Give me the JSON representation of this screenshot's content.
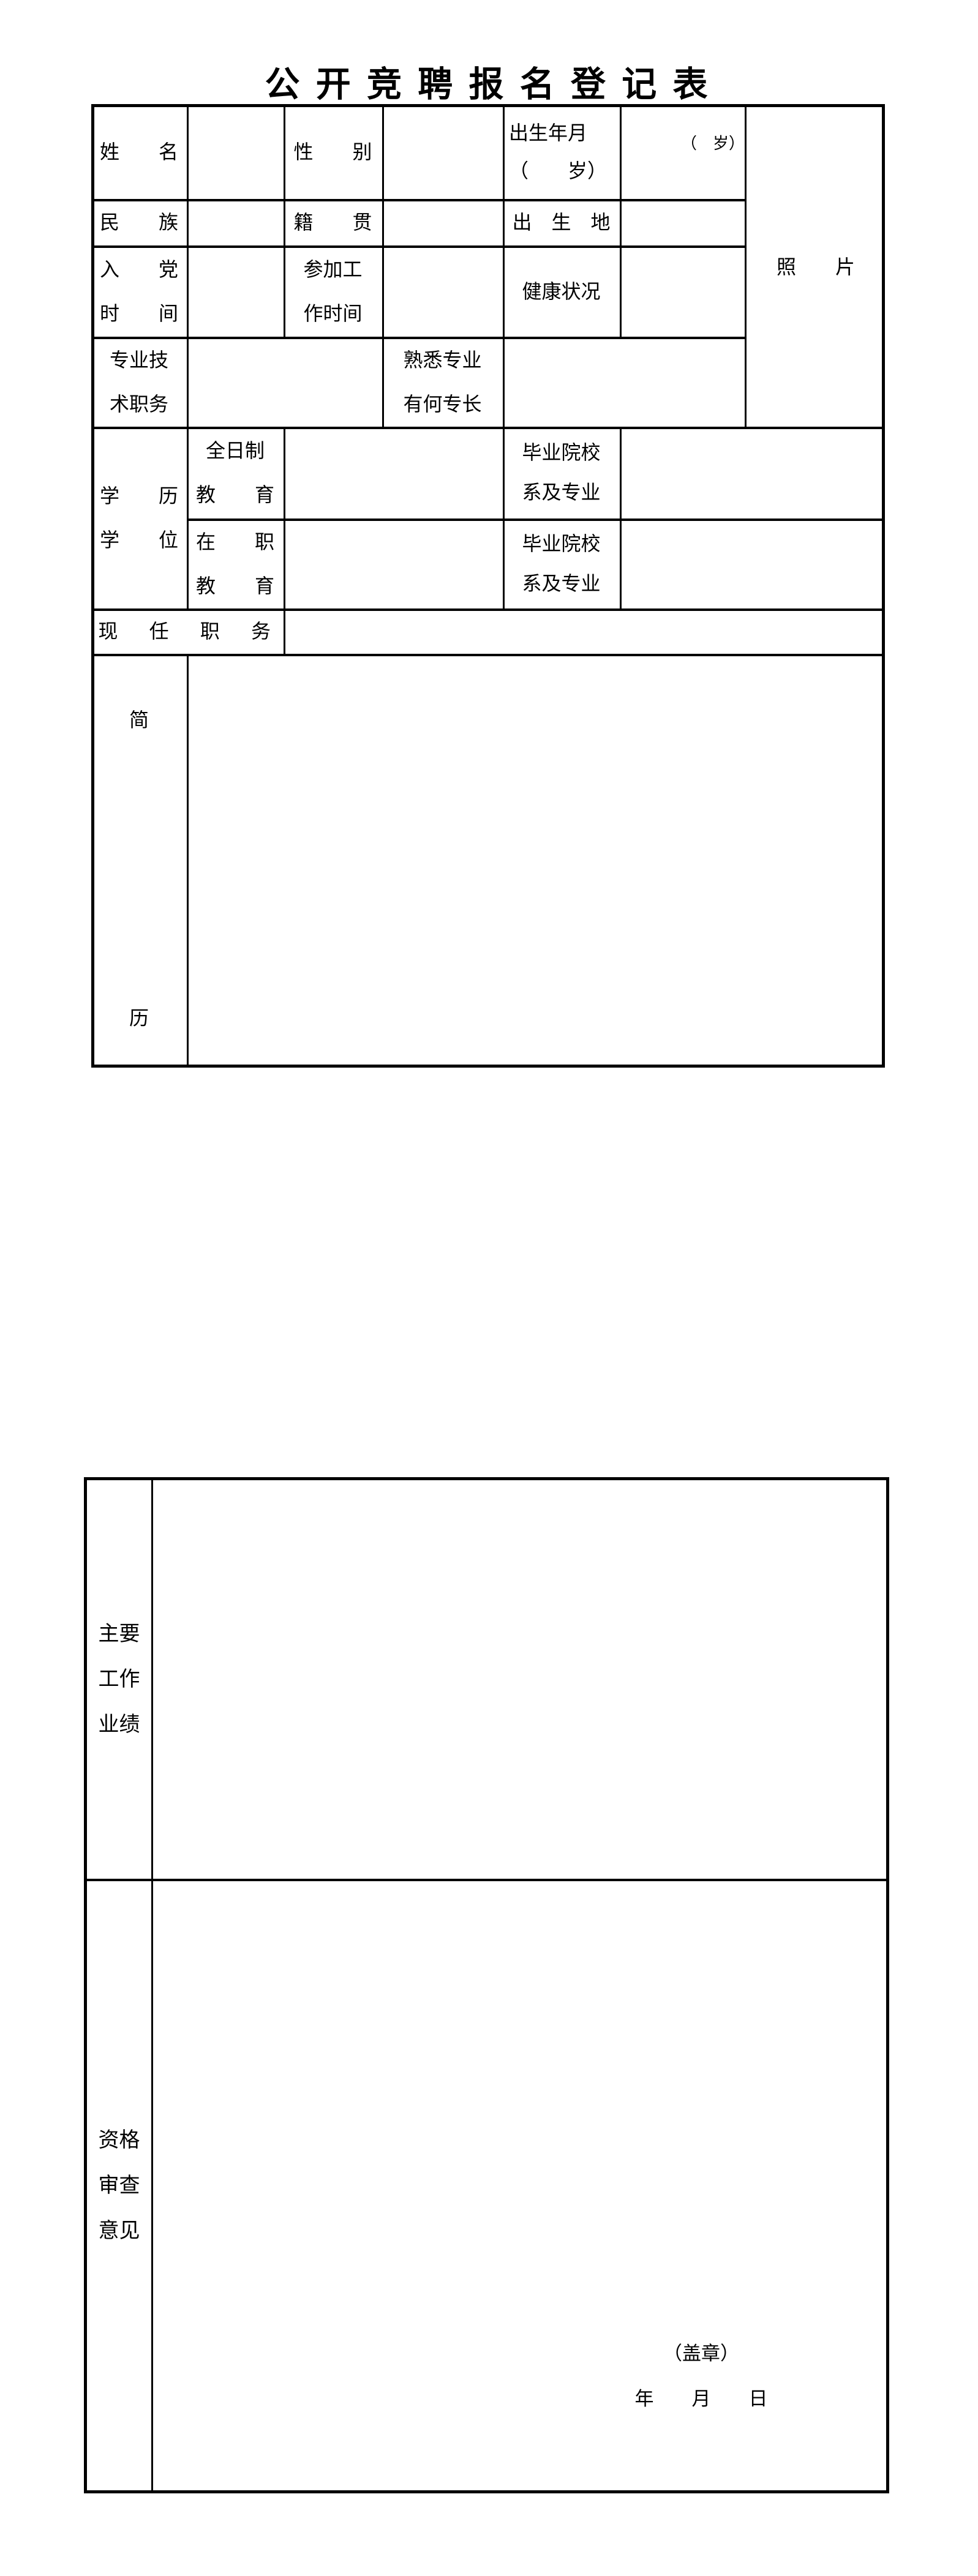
{
  "title": "公 开 竞 聘 报 名 登 记 表",
  "form": {
    "name_label": "姓　　名",
    "gender_label": "性　　别",
    "birth_date_label_l1": "出生年月",
    "birth_date_label_l2": "（　　岁）",
    "age_hint": "（　岁）",
    "ethnicity_label": "民　　族",
    "native_place_label": "籍　　贯",
    "birthplace_label": "出　生　地",
    "party_time_label_l1": "入　　党",
    "party_time_label_l2": "时　　间",
    "work_time_label_l1": "参加工",
    "work_time_label_l2": "作时间",
    "health_label": "健康状况",
    "photo_label": "照　　片",
    "prof_title_label_l1": "专业技",
    "prof_title_label_l2": "术职务",
    "specialty_label_l1": "熟悉专业",
    "specialty_label_l2": "有何专长",
    "edu_degree_label_l1": "学　　历",
    "edu_degree_label_l2": "学　　位",
    "fulltime_label_l1": "全日制",
    "fulltime_label_l2": "教　　育",
    "onjob_label_l1": "在　　职",
    "onjob_label_l2": "教　　育",
    "school_major_label_l1": "毕业院校",
    "school_major_label_l2": "系及专业",
    "school_major2_label_l1": "毕业院校",
    "school_major2_label_l2": "系及专业",
    "current_post_label": "现　任　职　务",
    "resume_label_l1": "简",
    "resume_label_l2": "历",
    "achievements_label_l1": "主要",
    "achievements_label_l2": "工作",
    "achievements_label_l3": "业绩",
    "review_label_l1": "资格",
    "review_label_l2": "审查",
    "review_label_l3": "意见",
    "seal_hint": "（盖章）",
    "date_hint": "年　　月　　日"
  }
}
